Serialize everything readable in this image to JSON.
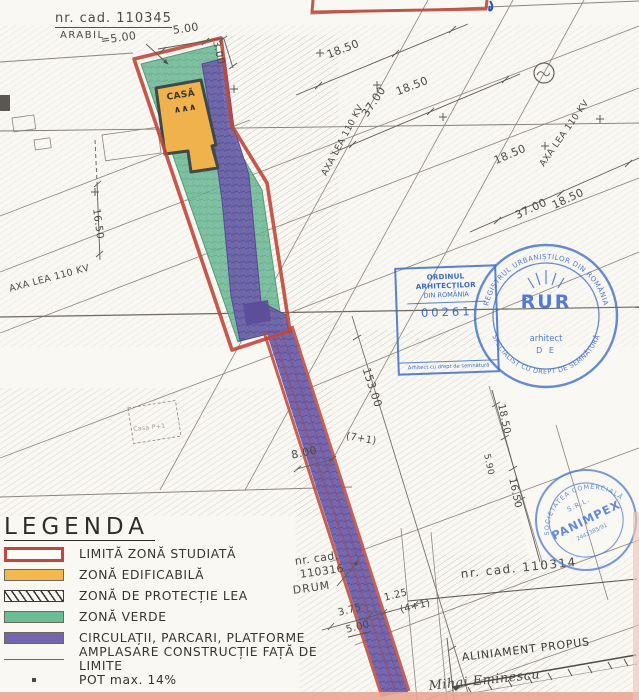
{
  "colors": {
    "boundary_red": "#c0473a",
    "zone_green": "#68b893",
    "zone_orange": "#f0b24c",
    "zone_purple": "#7163ae",
    "stamp_blue": "#3e6ecd",
    "pencil_gray": "#6e6a63",
    "salmon_band": "#eaa593"
  },
  "map": {
    "parcel": {
      "nr_cad": "nr. cad. 110345",
      "arabil": "ARABIL",
      "casa": "CASĂ",
      "casa_symbol": "∧∧∧",
      "casa_p1": "Casa P+1"
    },
    "dims": {
      "top_500": "5.00",
      "eq_500": "=5.00",
      "right_300": "3.00",
      "a_1850": "18.50",
      "b_1850": "18.50",
      "a_3700": "37.00",
      "c_1850": "18.50",
      "d_1850": "18.50",
      "b_3700": "37.00",
      "left_1650": "16.50",
      "road_15300": "153.00",
      "road_800": "8.00",
      "road_71": "(7+1)",
      "e_1850": "18.50",
      "r_590": "5.90",
      "r_1650": "16.50",
      "s_375": "3.75",
      "s_125": "1.25",
      "s_500": "5.00",
      "s_41": "(4+1)"
    },
    "axes": {
      "lea_left": "AXA LEA 110 KV",
      "lea_mid": "AXA LEA 110 KV",
      "lea_right": "AXA LEA 110 KV"
    },
    "notes": {
      "cad2_l1": "nr. cad.",
      "cad2_l2": "110316",
      "cad2_l3": "DRUM",
      "cad3": "nr. cad. 110314",
      "aliniament": "ALINIAMENT PROPUS",
      "street": "Mihai Eminescu"
    }
  },
  "legend": {
    "title": "LEGENDA",
    "items": [
      {
        "label": "LIMITĂ ZONĂ STUDIATĂ"
      },
      {
        "label": "ZONĂ EDIFICABILĂ"
      },
      {
        "label": "ZONĂ DE PROTECȚIE LEA"
      },
      {
        "label": "ZONĂ VERDE"
      },
      {
        "label": "CIRCULAȚII, PARCARI, PLATFORME"
      },
      {
        "label": "AMPLASARE CONSTRUCȚIE FAȚĂ DE LIMITE"
      },
      {
        "label": "POT max. 14%"
      }
    ]
  },
  "stamps": {
    "oar": {
      "org": "ORDINUL ARHITECȚILOR",
      "country": "DIN ROMÂNIA",
      "number": "00261",
      "footer": "Arhitect cu drept de semnătură"
    },
    "rur": {
      "ring_top": "REGISTRUL URBANIȘTILOR DIN ROMÂNIA",
      "ring_bottom": "SPECIALIST CU DREPT DE SEMNĂTURĂ",
      "acronym": "RUR",
      "role": "arhitect",
      "initials": "D E"
    },
    "panimpex": {
      "ring_top": "SOCIETATEA COMERCIALĂ",
      "srl": "S.R.L.",
      "name": "PANIMPEX",
      "number": "2441385/91"
    }
  }
}
